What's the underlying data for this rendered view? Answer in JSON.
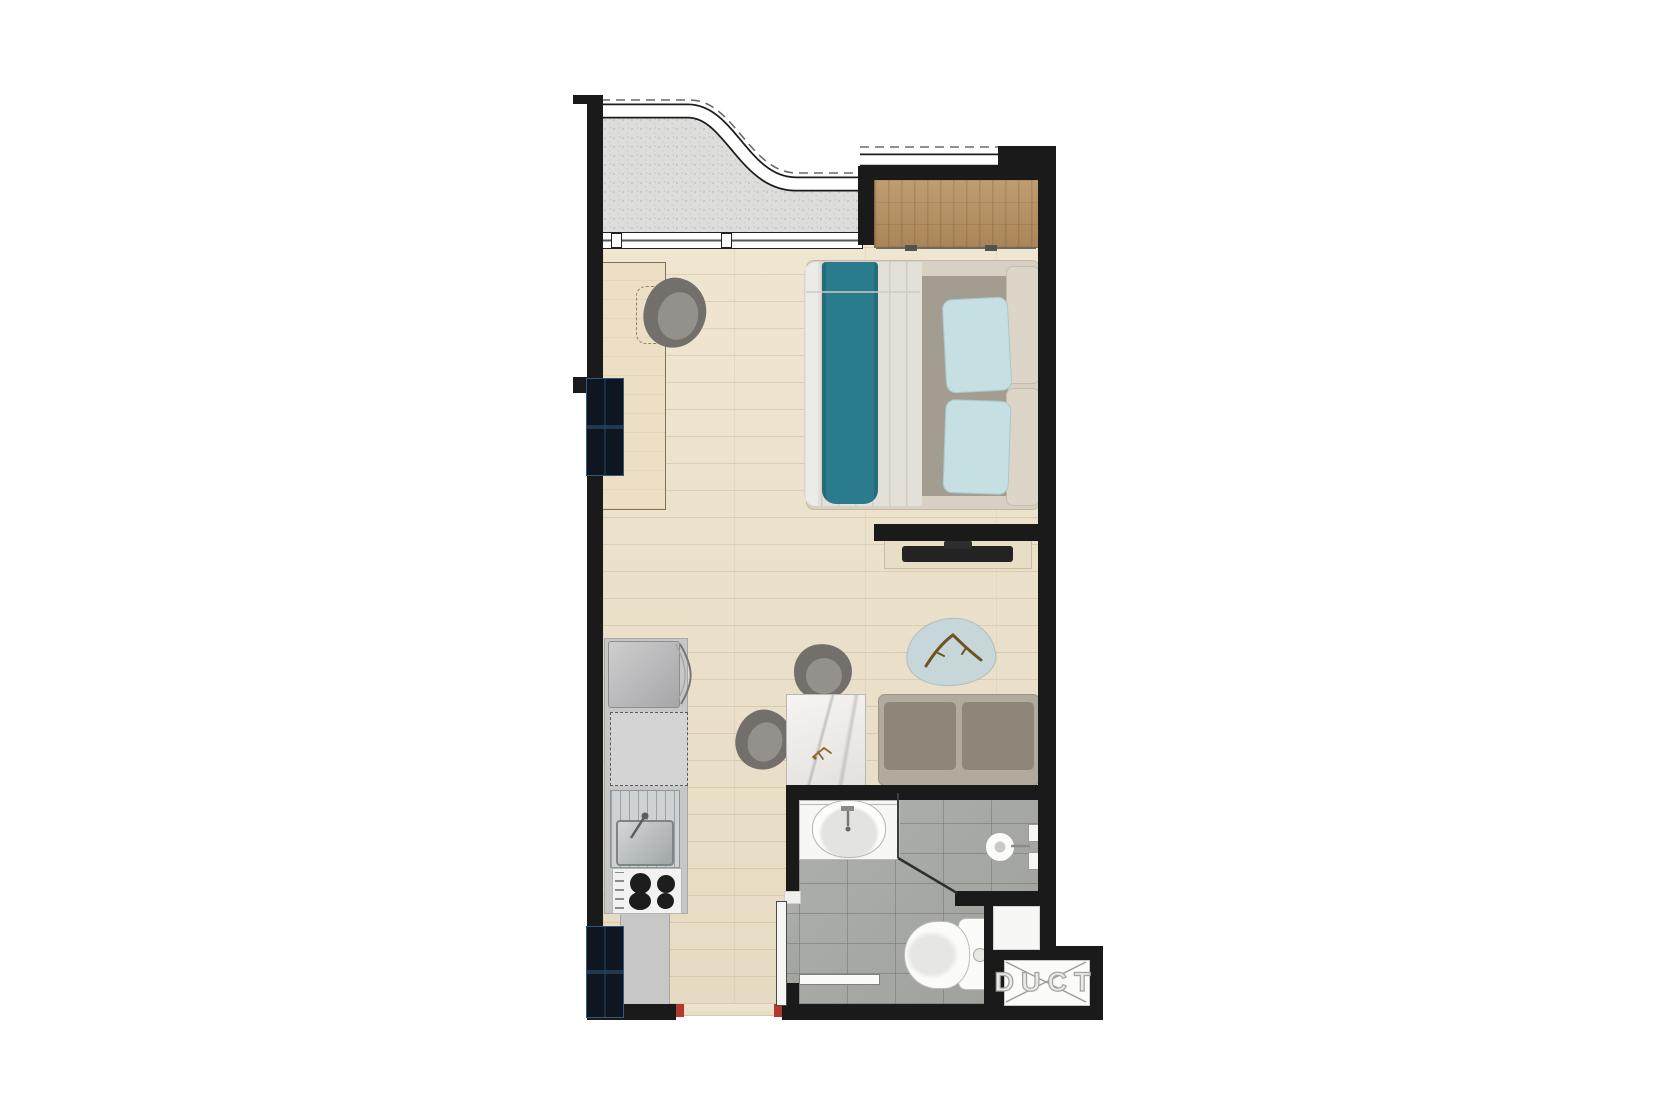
{
  "title": "Studio apartment floor plan (top-down render)",
  "labels": {
    "duct": "DUCT"
  },
  "colors": {
    "wall": "#1a1a1a",
    "wood_floor": "#ebdfc6",
    "tile_floor": "#a8aaa5",
    "balcony_floor": "#dcdcda",
    "wardrobe_wood": "#b8905e",
    "teal_blanket": "#2a7b8b",
    "pillow_blue": "#c5dfe3",
    "duvet": "#e3e0da",
    "sofa_cushion": "#8e8779",
    "rug_blue": "#c7d6d9",
    "marble_table": "#eceae6",
    "appliance_gray": "#c7c7c7",
    "door_marker_red": "#b03a2e",
    "window_glass": "#0e1622"
  },
  "rooms": [
    {
      "name": "balcony"
    },
    {
      "name": "sleeping-area"
    },
    {
      "name": "living-dining-area"
    },
    {
      "name": "kitchenette"
    },
    {
      "name": "bathroom"
    },
    {
      "name": "entry-hall"
    },
    {
      "name": "duct-shaft"
    }
  ],
  "furniture": [
    "wardrobe",
    "double-bed",
    "desk",
    "desk-chair",
    "tv-wall",
    "tv-console",
    "rug-coffee-table",
    "sofa",
    "dining-table",
    "dining-chairs",
    "fridge",
    "kitchen-cabinet",
    "kitchen-sink",
    "cooktop",
    "kitchen-counter",
    "washbasin-counter",
    "shower",
    "toilet",
    "towel-bar",
    "entry-door",
    "windows"
  ]
}
